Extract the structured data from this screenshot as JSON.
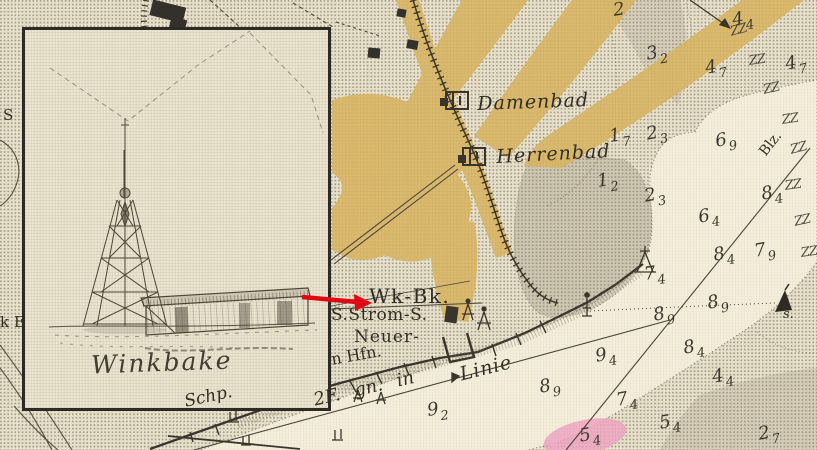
{
  "inset": {
    "caption": "Winkbake"
  },
  "map": {
    "labels": {
      "damenbad": "Damenbad",
      "herrenbad": "Herrenbad",
      "wk_bk": "Wk-Bk.",
      "strom": "S.Strom-S.",
      "neuer": "Neuer-",
      "hfn": "n Hfn.",
      "schp": "Schp.",
      "leading_line": "2F. gn. in",
      "linie": "Linie",
      "blz": "Blz.",
      "buoy": "s.",
      "edge_fragment_s": "S",
      "edge_fragment_ke": "k E"
    },
    "seaweed_glyph": "Z",
    "soundings": [
      {
        "v": "2",
        "s": "",
        "x": 612,
        "y": 2,
        "r": -8
      },
      {
        "v": "4",
        "s": "4",
        "x": 731,
        "y": 12,
        "r": -10
      },
      {
        "v": "3",
        "s": "2",
        "x": 645,
        "y": 46,
        "r": -10
      },
      {
        "v": "4",
        "s": "7",
        "x": 704,
        "y": 60,
        "r": -10
      },
      {
        "v": "4",
        "s": "7",
        "x": 784,
        "y": 56,
        "r": -10
      },
      {
        "v": "1",
        "s": "7",
        "x": 608,
        "y": 128,
        "r": -8
      },
      {
        "v": "2",
        "s": "3",
        "x": 645,
        "y": 126,
        "r": -10
      },
      {
        "v": "6",
        "s": "9",
        "x": 714,
        "y": 133,
        "r": -10
      },
      {
        "v": "1",
        "s": "2",
        "x": 596,
        "y": 173,
        "r": -8
      },
      {
        "v": "2",
        "s": "3",
        "x": 643,
        "y": 188,
        "r": -10
      },
      {
        "v": "6",
        "s": "4",
        "x": 697,
        "y": 209,
        "r": -10
      },
      {
        "v": "8",
        "s": "4",
        "x": 760,
        "y": 186,
        "r": -10
      },
      {
        "v": "7",
        "s": "9",
        "x": 753,
        "y": 243,
        "r": -10
      },
      {
        "v": "8",
        "s": "4",
        "x": 712,
        "y": 247,
        "r": -10
      },
      {
        "v": "7",
        "s": "4",
        "x": 643,
        "y": 266,
        "r": -8
      },
      {
        "v": "8",
        "s": "9",
        "x": 706,
        "y": 295,
        "r": -10
      },
      {
        "v": "8",
        "s": "9",
        "x": 652,
        "y": 307,
        "r": -10
      },
      {
        "v": "8",
        "s": "4",
        "x": 682,
        "y": 340,
        "r": -10
      },
      {
        "v": "4",
        "s": "4",
        "x": 711,
        "y": 369,
        "r": -10
      },
      {
        "v": "9",
        "s": "4",
        "x": 594,
        "y": 348,
        "r": -10
      },
      {
        "v": "8",
        "s": "9",
        "x": 538,
        "y": 379,
        "r": -10
      },
      {
        "v": "7",
        "s": "4",
        "x": 615,
        "y": 392,
        "r": -10
      },
      {
        "v": "5",
        "s": "4",
        "x": 658,
        "y": 415,
        "r": -10
      },
      {
        "v": "5",
        "s": "4",
        "x": 578,
        "y": 428,
        "r": -10
      },
      {
        "v": "2",
        "s": "7",
        "x": 757,
        "y": 426,
        "r": -10
      },
      {
        "v": "9",
        "s": "2",
        "x": 426,
        "y": 402,
        "r": -8
      }
    ],
    "seaweed": [
      {
        "x": 729,
        "y": 26,
        "r": -15
      },
      {
        "x": 748,
        "y": 55,
        "r": -8
      },
      {
        "x": 762,
        "y": 84,
        "r": -12
      },
      {
        "x": 781,
        "y": 114,
        "r": -8
      },
      {
        "x": 789,
        "y": 144,
        "r": -14
      },
      {
        "x": 784,
        "y": 180,
        "r": -8
      },
      {
        "x": 793,
        "y": 216,
        "r": -12
      },
      {
        "x": 800,
        "y": 247,
        "r": -8
      }
    ]
  },
  "colors": {
    "paper": "#e9e2cd",
    "channel": "#f3edda",
    "road": "#d9b664",
    "pink_area": "#efa6c3",
    "ink": "#3a352c",
    "arrow_red": "#e30613"
  }
}
